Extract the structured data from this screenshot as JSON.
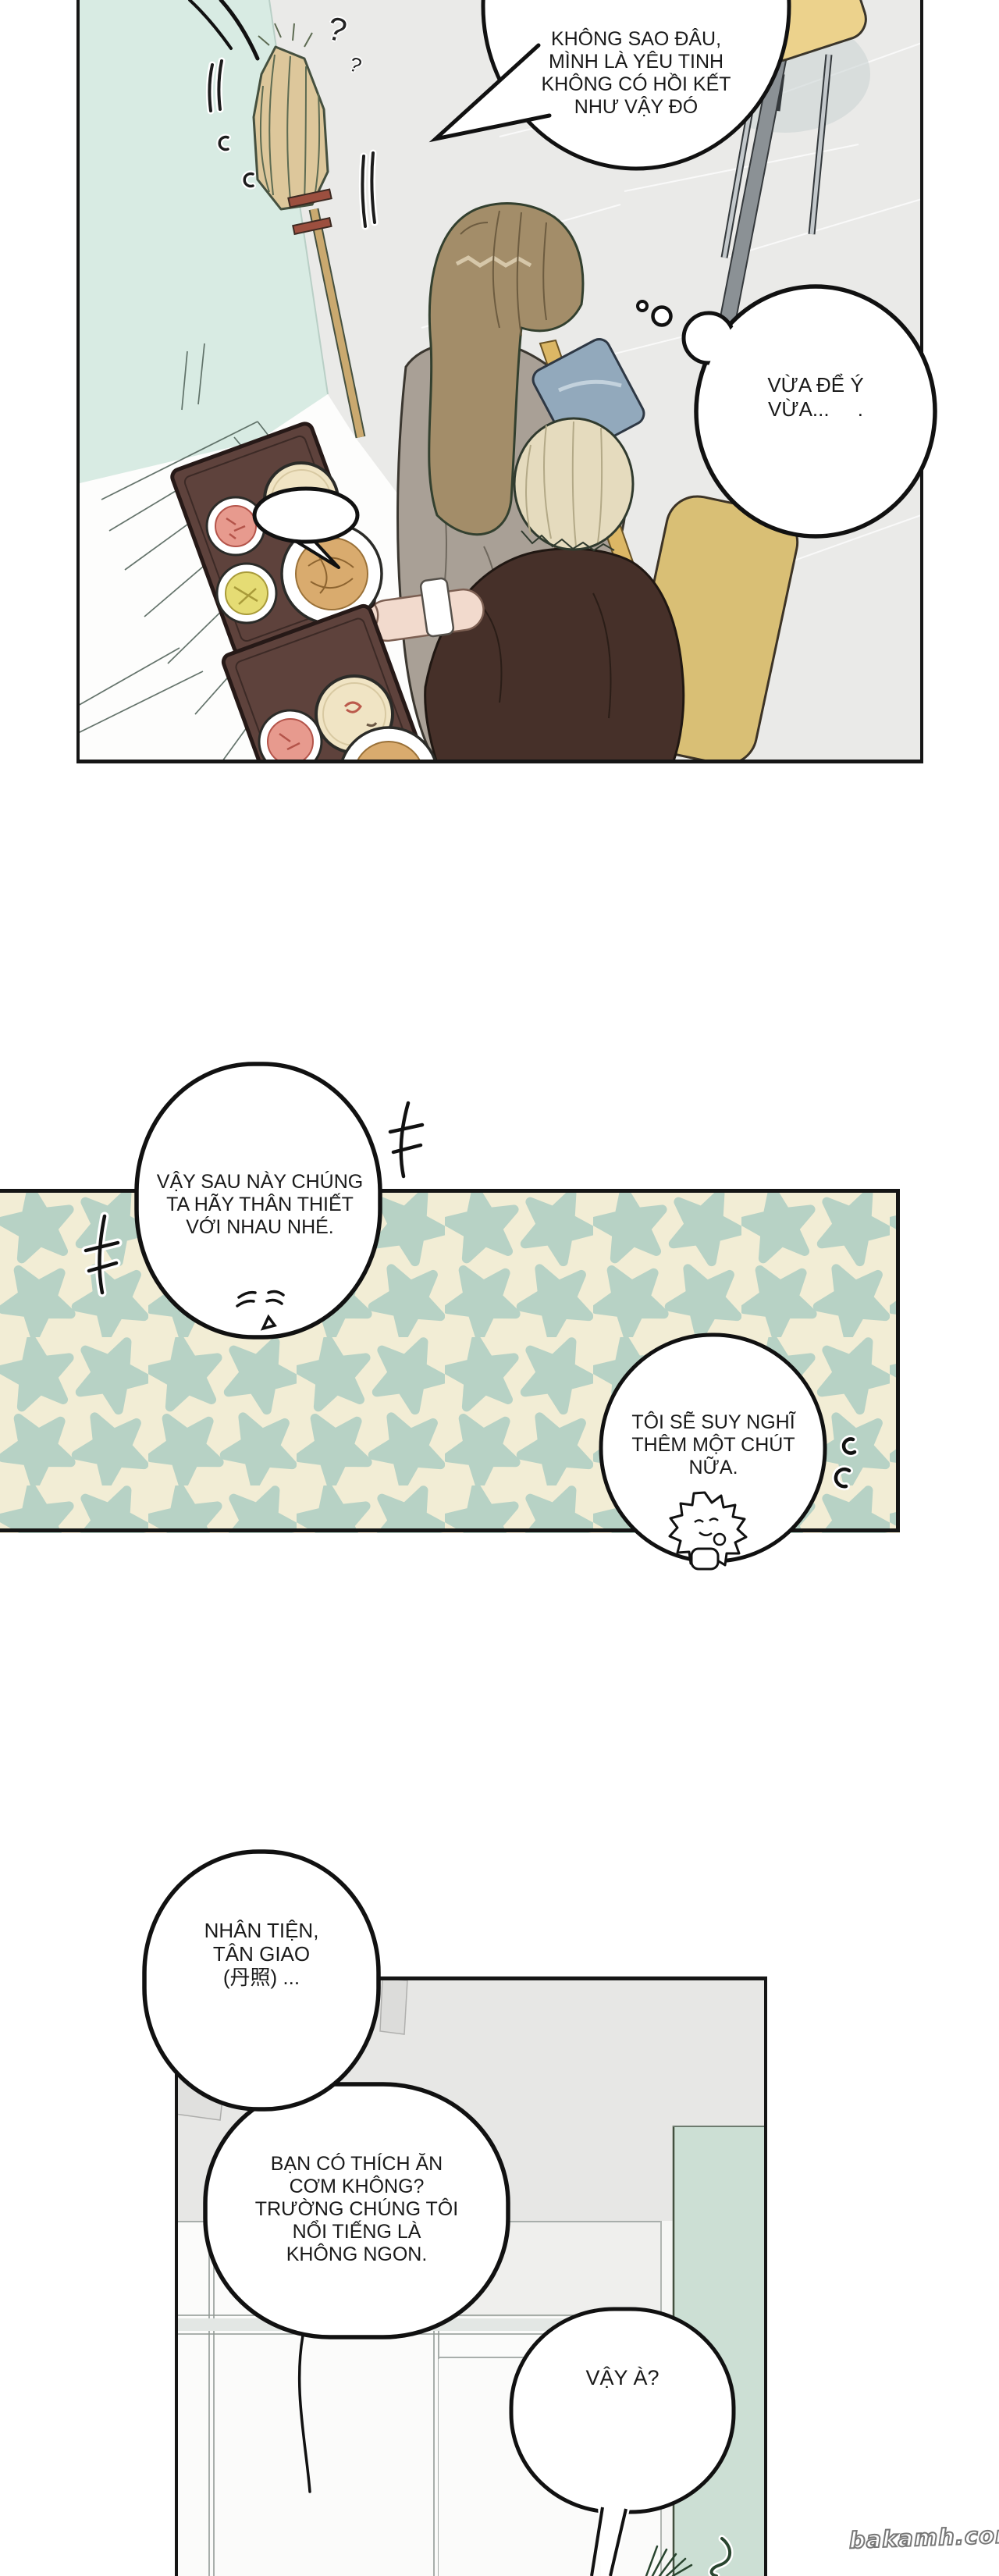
{
  "page": {
    "watermark": "bakamh.com",
    "background": "#ffffff"
  },
  "colors": {
    "panel_border": "#151515",
    "mint_wall": "#d8ebe3",
    "tile_floor": "#eaeae8",
    "counter_white": "#fdfdfc",
    "tray_brown": "#5e423c",
    "soup_cream": "#f0e4c4",
    "noodle_tan": "#d9ab6e",
    "pink_food": "#e79a8e",
    "yellow_food": "#e5dc74",
    "broom_straw": "#ddc79b",
    "girl_hair_brown": "#a38d69",
    "cardigan_taupe": "#a9a096",
    "blond_hair": "#e5dbbe",
    "outfit_maroon": "#463029",
    "bag_blue": "#92a9bc",
    "strap_yellow": "#dcb765",
    "chair_yellow": "#ecd28c",
    "star_green": "#b7d2c5",
    "star_cream": "#f2edd5",
    "panel3_wall_gray": "#e7e7e5",
    "panel3_mint": "#ccdfd4"
  },
  "panel1": {
    "speech_bubble": {
      "lines": "KHÔNG SAO ĐÂU,\nMÌNH LÀ YÊU TINH\nKHÔNG CÓ HỒI KẾT\nNHƯ VẬY ĐÓ"
    },
    "thought_bubble": {
      "lines": "VỪA ĐỂ Ý\nVỪA...     ."
    },
    "sfx_question_large": "?",
    "sfx_question_small": "?"
  },
  "panel2": {
    "speech_bubble_left": {
      "lines": "VẬY SAU NÀY CHÚNG\nTA HÃY THÂN THIẾT\nVỚI NHAU NHÉ."
    },
    "speech_bubble_right": {
      "lines": "TÔI SẼ SUY NGHĨ\nTHÊM MỘT CHÚT\nNỮA."
    }
  },
  "panel3": {
    "speech_bubble_top": {
      "lines": "NHÂN TIỆN,\nTÂN GIAO\n(丹照) ..."
    },
    "speech_bubble_mid": {
      "lines": "BẠN CÓ THÍCH ĂN\nCƠM KHÔNG?\nTRƯỜNG CHÚNG TÔI\nNỔI TIẾNG LÀ\nKHÔNG NGON."
    },
    "speech_bubble_small": {
      "lines": "VẬY À?"
    }
  }
}
